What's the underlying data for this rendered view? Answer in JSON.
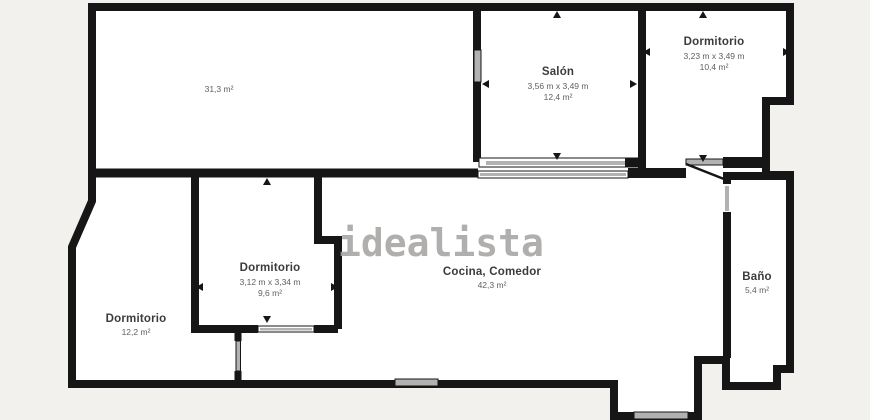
{
  "image_type": "real-estate floor plan",
  "watermark": {
    "text": "idealista"
  },
  "colors": {
    "background": "#f2f1ee",
    "wall": "#161616",
    "room_fill": "#ffffff",
    "opening": "#b4b2b0",
    "watermark": "#a8a7a5",
    "label": "#3b3b3b",
    "label_secondary": "#5f5f5f"
  },
  "rooms": [
    {
      "key": "sala-grande",
      "name": "",
      "dims": "",
      "area": "31,3 m²"
    },
    {
      "key": "salon",
      "name": "Salón",
      "dims": "3,56 m x 3,49 m",
      "area": "12,4 m²"
    },
    {
      "key": "dormitorio-derecha",
      "name": "Dormitorio",
      "dims": "3,23 m x 3,49 m",
      "area": "10,4 m²"
    },
    {
      "key": "dormitorio-centro",
      "name": "Dormitorio",
      "dims": "3,12 m x 3,34 m",
      "area": "9,6 m²"
    },
    {
      "key": "dormitorio-izquierda",
      "name": "Dormitorio",
      "dims": "",
      "area": "12,2 m²"
    },
    {
      "key": "cocina-comedor",
      "name": "Cocina, Comedor",
      "dims": "",
      "area": "42,3 m²"
    },
    {
      "key": "bano",
      "name": "Baño",
      "dims": "",
      "area": "5,4 m²"
    }
  ]
}
